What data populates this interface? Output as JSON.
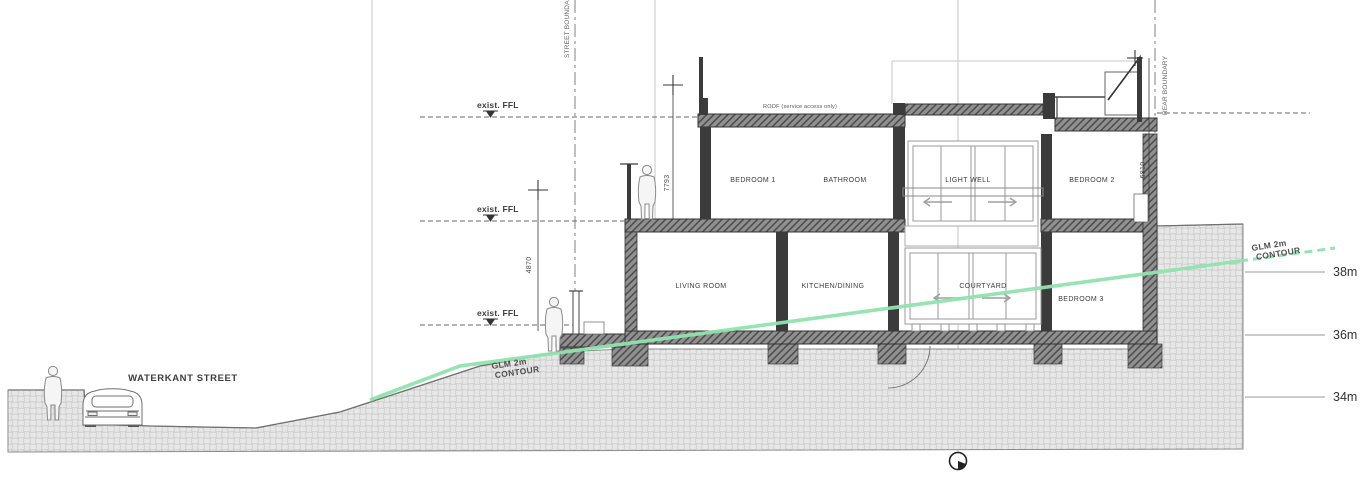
{
  "labels": {
    "street": "WATERKANT STREET",
    "roof": "ROOF (service access only)",
    "exist_ffl": "exist. FFL",
    "street_boundary": "STREET BOUNDARY",
    "rear_boundary": "REAR BOUNDARY",
    "contour_line1": "GLM 2m",
    "contour_line2": "CONTOUR"
  },
  "rooms": {
    "upper": [
      "BEDROOM 1",
      "BATHROOM",
      "LIGHT WELL",
      "BEDROOM 2"
    ],
    "lower": [
      "LIVING ROOM",
      "KITCHEN/DINING",
      "COURTYARD",
      "BEDROOM 3"
    ]
  },
  "dimensions": {
    "upper_storey": "7793",
    "lower_storey": "4870",
    "rear_storey": "6810"
  },
  "elevations": [
    "38m",
    "36m",
    "34m"
  ],
  "colors": {
    "contour_green": "#8fe3ad",
    "ink": "#3c3c3c",
    "hatch_gray": "#bfbfbf"
  }
}
